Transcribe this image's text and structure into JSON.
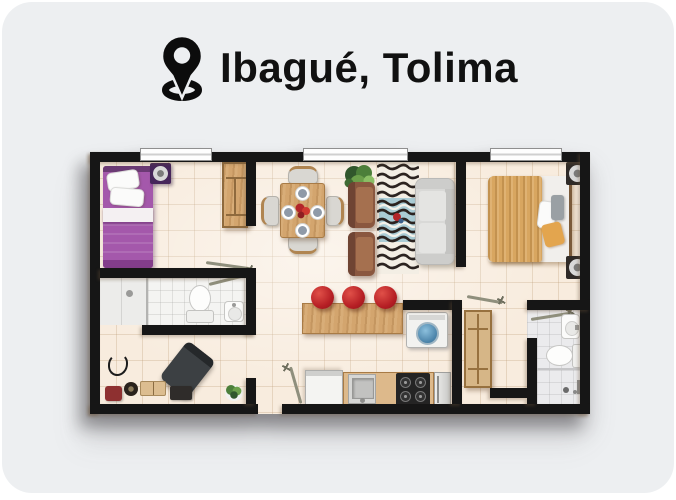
{
  "header": {
    "location_label": "Ibagué, Tolima",
    "icon": "location-pin-icon"
  },
  "palette": {
    "page_background": "#ffffff",
    "card_background": "#edeff1",
    "wall_color": "#161616",
    "floor_cream": "#f8ecde",
    "floor_grid": "#d8c2a4",
    "bathroom_floor": "#f4f4f2",
    "wood": "#d3a56e",
    "bed_purple": "#a458ab",
    "master_blanket_tan": "#d8a660",
    "sofa_gray": "#d9d9d7",
    "armchair_brown": "#8a573f",
    "stool_red": "#b51e24",
    "washer_lid_blue": "#5d96ba",
    "rug_blue": "#a4c9d4",
    "title_color": "#111111"
  }
}
